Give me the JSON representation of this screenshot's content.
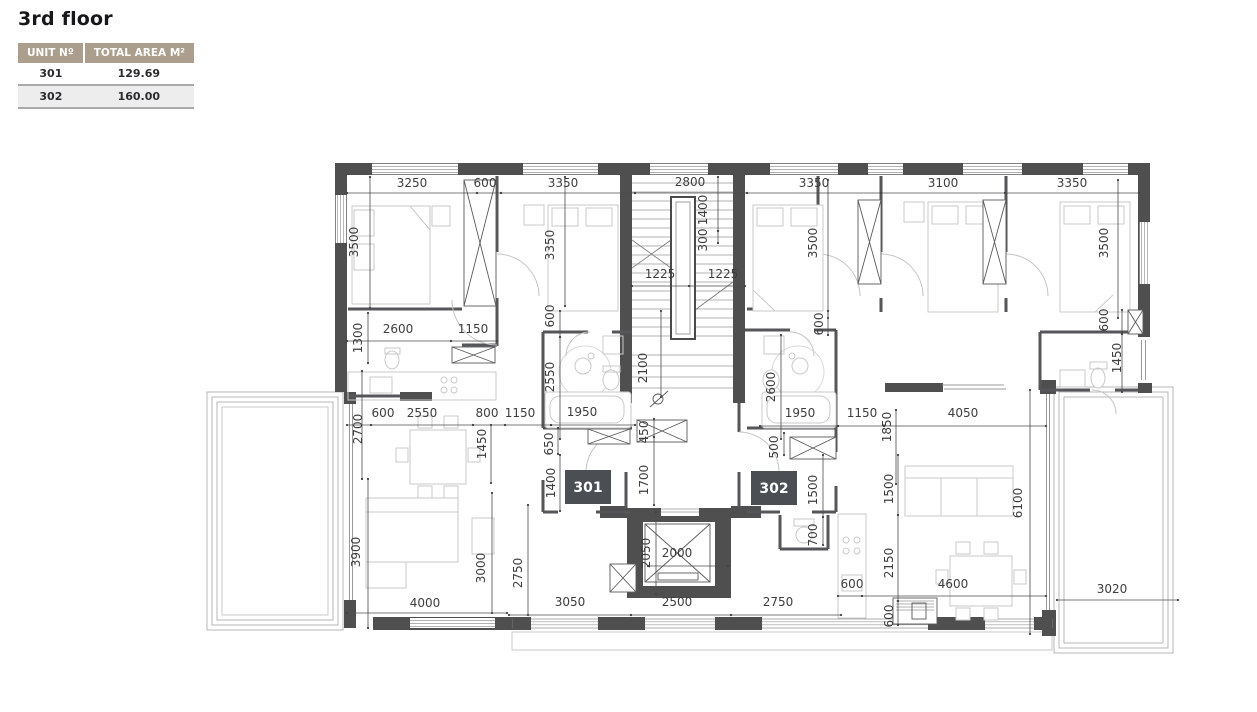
{
  "page": {
    "title": "3rd floor"
  },
  "table": {
    "headers": [
      "UNIT Nº",
      "TOTAL AREA M²"
    ],
    "rows": [
      {
        "unit": "301",
        "area": "129.69"
      },
      {
        "unit": "302",
        "area": "160.00"
      }
    ]
  },
  "colors": {
    "header_bg": "#ab9e8c",
    "wall": "#4f4f4f",
    "badge_bg": "#4b4e53",
    "dim_text": "#3d3d3d",
    "furniture": "#c9c9c9"
  },
  "plan": {
    "unit_badges": [
      {
        "label": "301",
        "x": 588,
        "y": 487
      },
      {
        "label": "302",
        "x": 774,
        "y": 488
      }
    ],
    "dim_labels": [
      {
        "t": "3250",
        "x": 412,
        "y": 187,
        "r": 0
      },
      {
        "t": "600",
        "x": 485,
        "y": 187,
        "r": 0
      },
      {
        "t": "3350",
        "x": 563,
        "y": 187,
        "r": 0
      },
      {
        "t": "2800",
        "x": 690,
        "y": 186,
        "r": 0
      },
      {
        "t": "3350",
        "x": 814,
        "y": 187,
        "r": 0
      },
      {
        "t": "3100",
        "x": 943,
        "y": 187,
        "r": 0
      },
      {
        "t": "3350",
        "x": 1072,
        "y": 187,
        "r": 0
      },
      {
        "t": "3500",
        "x": 358,
        "y": 242,
        "r": 1
      },
      {
        "t": "3350",
        "x": 554,
        "y": 245,
        "r": 1
      },
      {
        "t": "1400",
        "x": 707,
        "y": 210,
        "r": 1
      },
      {
        "t": "300",
        "x": 707,
        "y": 240,
        "r": 1
      },
      {
        "t": "1225",
        "x": 660,
        "y": 278,
        "r": 0
      },
      {
        "t": "1225",
        "x": 723,
        "y": 278,
        "r": 0
      },
      {
        "t": "3500",
        "x": 817,
        "y": 243,
        "r": 1
      },
      {
        "t": "3500",
        "x": 1108,
        "y": 243,
        "r": 1
      },
      {
        "t": "2100",
        "x": 647,
        "y": 368,
        "r": 1
      },
      {
        "t": "1300",
        "x": 362,
        "y": 338,
        "r": 1
      },
      {
        "t": "2600",
        "x": 398,
        "y": 333,
        "r": 0
      },
      {
        "t": "1150",
        "x": 473,
        "y": 333,
        "r": 0
      },
      {
        "t": "600",
        "x": 554,
        "y": 316,
        "r": 1
      },
      {
        "t": "2550",
        "x": 554,
        "y": 377,
        "r": 1
      },
      {
        "t": "2700",
        "x": 362,
        "y": 429,
        "r": 1
      },
      {
        "t": "600",
        "x": 383,
        "y": 417,
        "r": 0
      },
      {
        "t": "2550",
        "x": 422,
        "y": 417,
        "r": 0
      },
      {
        "t": "800",
        "x": 487,
        "y": 417,
        "r": 0
      },
      {
        "t": "1150",
        "x": 520,
        "y": 417,
        "r": 0
      },
      {
        "t": "1950",
        "x": 582,
        "y": 416,
        "r": 0
      },
      {
        "t": "1450",
        "x": 486,
        "y": 444,
        "r": 1
      },
      {
        "t": "650",
        "x": 553,
        "y": 444,
        "r": 1
      },
      {
        "t": "1400",
        "x": 555,
        "y": 483,
        "r": 1
      },
      {
        "t": "450",
        "x": 648,
        "y": 432,
        "r": 1
      },
      {
        "t": "1700",
        "x": 648,
        "y": 480,
        "r": 1
      },
      {
        "t": "3900",
        "x": 360,
        "y": 552,
        "r": 1
      },
      {
        "t": "3000",
        "x": 485,
        "y": 568,
        "r": 1
      },
      {
        "t": "2750",
        "x": 522,
        "y": 573,
        "r": 1
      },
      {
        "t": "2050",
        "x": 650,
        "y": 553,
        "r": 1
      },
      {
        "t": "2000",
        "x": 677,
        "y": 557,
        "r": 0
      },
      {
        "t": "4000",
        "x": 425,
        "y": 607,
        "r": 0
      },
      {
        "t": "3050",
        "x": 570,
        "y": 606,
        "r": 0
      },
      {
        "t": "2500",
        "x": 677,
        "y": 606,
        "r": 0
      },
      {
        "t": "2750",
        "x": 778,
        "y": 606,
        "r": 0
      },
      {
        "t": "600",
        "x": 823,
        "y": 324,
        "r": 1
      },
      {
        "t": "2600",
        "x": 775,
        "y": 387,
        "r": 1
      },
      {
        "t": "1950",
        "x": 800,
        "y": 417,
        "r": 0
      },
      {
        "t": "1150",
        "x": 862,
        "y": 417,
        "r": 0
      },
      {
        "t": "4050",
        "x": 963,
        "y": 417,
        "r": 0
      },
      {
        "t": "1850",
        "x": 891,
        "y": 427,
        "r": 1
      },
      {
        "t": "500",
        "x": 778,
        "y": 447,
        "r": 1
      },
      {
        "t": "1500",
        "x": 817,
        "y": 490,
        "r": 1
      },
      {
        "t": "1500",
        "x": 893,
        "y": 489,
        "r": 1
      },
      {
        "t": "700",
        "x": 817,
        "y": 535,
        "r": 1
      },
      {
        "t": "2150",
        "x": 893,
        "y": 563,
        "r": 1
      },
      {
        "t": "600",
        "x": 852,
        "y": 588,
        "r": 0
      },
      {
        "t": "4600",
        "x": 953,
        "y": 588,
        "r": 0
      },
      {
        "t": "600",
        "x": 893,
        "y": 616,
        "r": 1
      },
      {
        "t": "6100",
        "x": 1022,
        "y": 503,
        "r": 1
      },
      {
        "t": "600",
        "x": 1108,
        "y": 320,
        "r": 1
      },
      {
        "t": "1450",
        "x": 1121,
        "y": 358,
        "r": 1
      },
      {
        "t": "3020",
        "x": 1112,
        "y": 593,
        "r": 0
      }
    ]
  }
}
